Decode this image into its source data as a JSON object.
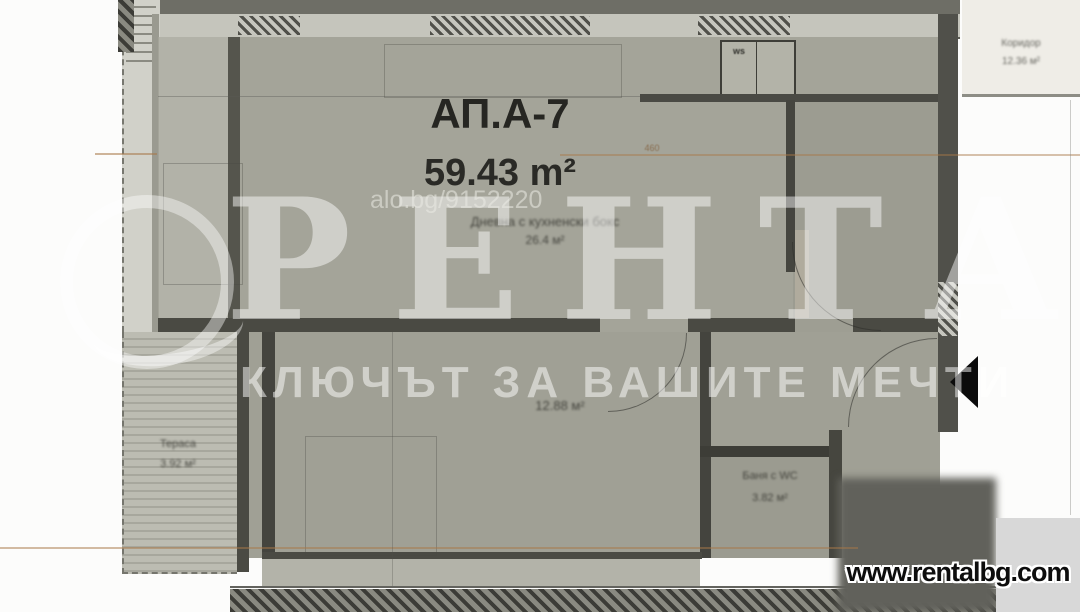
{
  "watermark": {
    "brand": "РЕНТАЛ",
    "tagline": "КЛЮЧЪТ ЗА ВАШИТЕ МЕЧТИ",
    "listing_ref": "alo.bg/9152220"
  },
  "plan": {
    "apartment_label": "АП.А-7",
    "total_area": "59.43 m²",
    "living_room": {
      "name": "Дневна с кухненски бокс",
      "area": "26.4 м²"
    },
    "bedroom": {
      "area": "12.88 м²"
    },
    "bathroom": {
      "name": "Баня с WC",
      "area": "3.82 м²"
    },
    "terrace": {
      "name": "Тераса",
      "area": "3.92 м²"
    },
    "corridor": {
      "name": "Коридор",
      "area": "12.36 м²"
    },
    "closet_label": "ws",
    "dimension_label": "460"
  },
  "footer": {
    "website": "www.rentalbg.com"
  },
  "colors": {
    "room_fill": "#a4a499",
    "wall": "#45453e",
    "terrace_fill": "#b9b9af",
    "dimension_line": "#a87848",
    "footer_bg": "#d8d8d8",
    "watermark": "rgba(255,255,255,0.47)"
  }
}
